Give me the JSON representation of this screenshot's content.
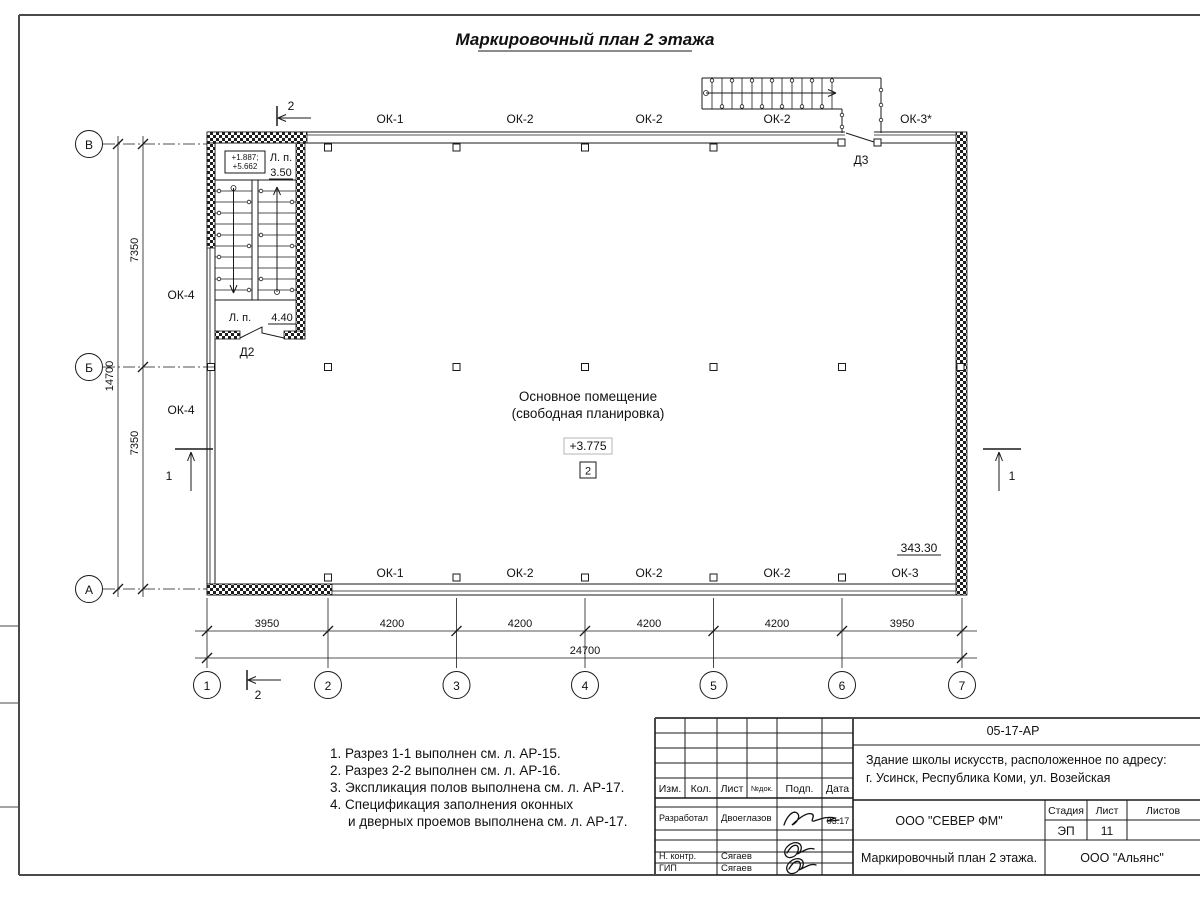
{
  "title": "Маркировочный план 2 этажа",
  "plan": {
    "room": {
      "name1": "Основное помещение",
      "name2": "(свободная планировка)",
      "elevation": "+3.775",
      "number": "2"
    },
    "area_mark": "343.30",
    "stair": {
      "elev1": "+1.887;",
      "elev2": "+5.662",
      "lp_top": "Л. п.",
      "lp_top_val": "3.50",
      "lp_bot": "Л. п.",
      "lp_bot_val": "4.40"
    },
    "windows_top": [
      "ОК-1",
      "ОК-2",
      "ОК-2",
      "ОК-2",
      "ОК-3*"
    ],
    "windows_bottom": [
      "ОК-1",
      "ОК-2",
      "ОК-2",
      "ОК-2",
      "ОК-3"
    ],
    "windows_left": [
      "ОК-4",
      "ОК-4"
    ],
    "door2": "Д2",
    "door3": "Д3",
    "section1": "1",
    "section2": "2"
  },
  "axes": {
    "cols": [
      "1",
      "2",
      "3",
      "4",
      "5",
      "6",
      "7"
    ],
    "rows": [
      "В",
      "Б",
      "А"
    ],
    "col_dims": [
      "3950",
      "4200",
      "4200",
      "4200",
      "4200",
      "3950"
    ],
    "col_total": "24700",
    "row_dims": [
      "7350",
      "7350"
    ],
    "row_total": "14700"
  },
  "notes": [
    "1. Разрез 1-1 выполнен см. л. АР-15.",
    "2. Разрез 2-2 выполнен см. л. АР-16.",
    "3. Экспликация полов выполнена см. л. АР-17.",
    "4. Спецификация заполнения оконных",
    "и дверных проемов выполнена см. л. АР-17."
  ],
  "titleblock": {
    "doc_code": "05-17-АР",
    "project1": "Здание школы искусств, расположенное по адресу:",
    "project2": "г. Усинск, Республика Коми, ул. Возейская",
    "cols": [
      "Изм.",
      "Кол.",
      "Лист",
      "№док.",
      "Подп.",
      "Дата"
    ],
    "developer_role": "Разработал",
    "developer_name": "Двоеглазов",
    "developer_date": "03.17",
    "ncontrol_role": "Н. контр.",
    "ncontrol_name": "Сягаев",
    "gip_role": "ГИП",
    "gip_name": "Сягаев",
    "org1": "ООО \"СЕВЕР ФМ\"",
    "stage_label": "Стадия",
    "sheet_label": "Лист",
    "sheets_label": "Листов",
    "stage": "ЭП",
    "sheet_num": "11",
    "sheet_title": "Маркировочный план 2 этажа.",
    "org2": "ООО \"Альянс\""
  }
}
